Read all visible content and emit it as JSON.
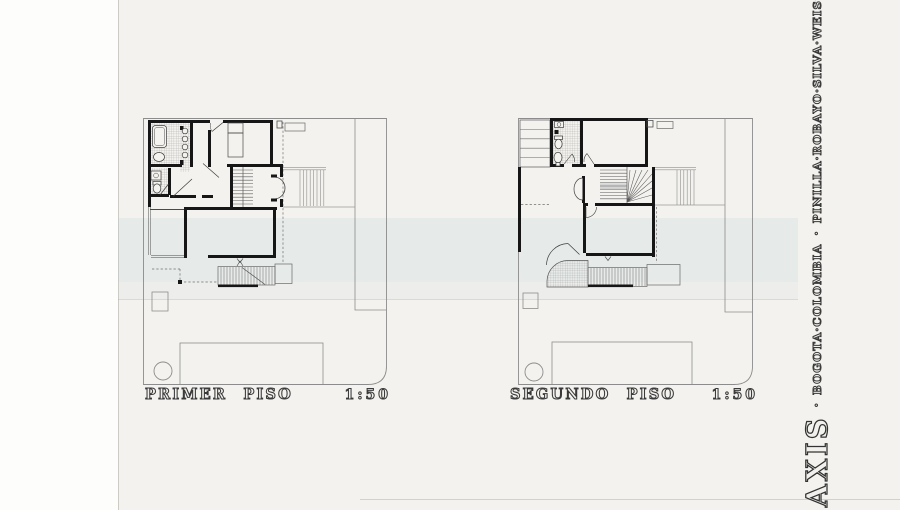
{
  "sheet": {
    "paper_color": "#f3f2ee",
    "ink_color": "#161616",
    "scan_band_color": "#bcccd8"
  },
  "plans": [
    {
      "title": "PRIMER PISO",
      "scale": "1:50"
    },
    {
      "title": "SEGUNDO PISO",
      "scale": "1:50"
    }
  ],
  "branding": {
    "firm": "AXIS",
    "separator": "·",
    "location": "BOGOTA·COLOMBIA",
    "partners": "PINILLA·ROBAYO·SILVA·WEISS",
    "role": "ARQUITECTOS"
  }
}
